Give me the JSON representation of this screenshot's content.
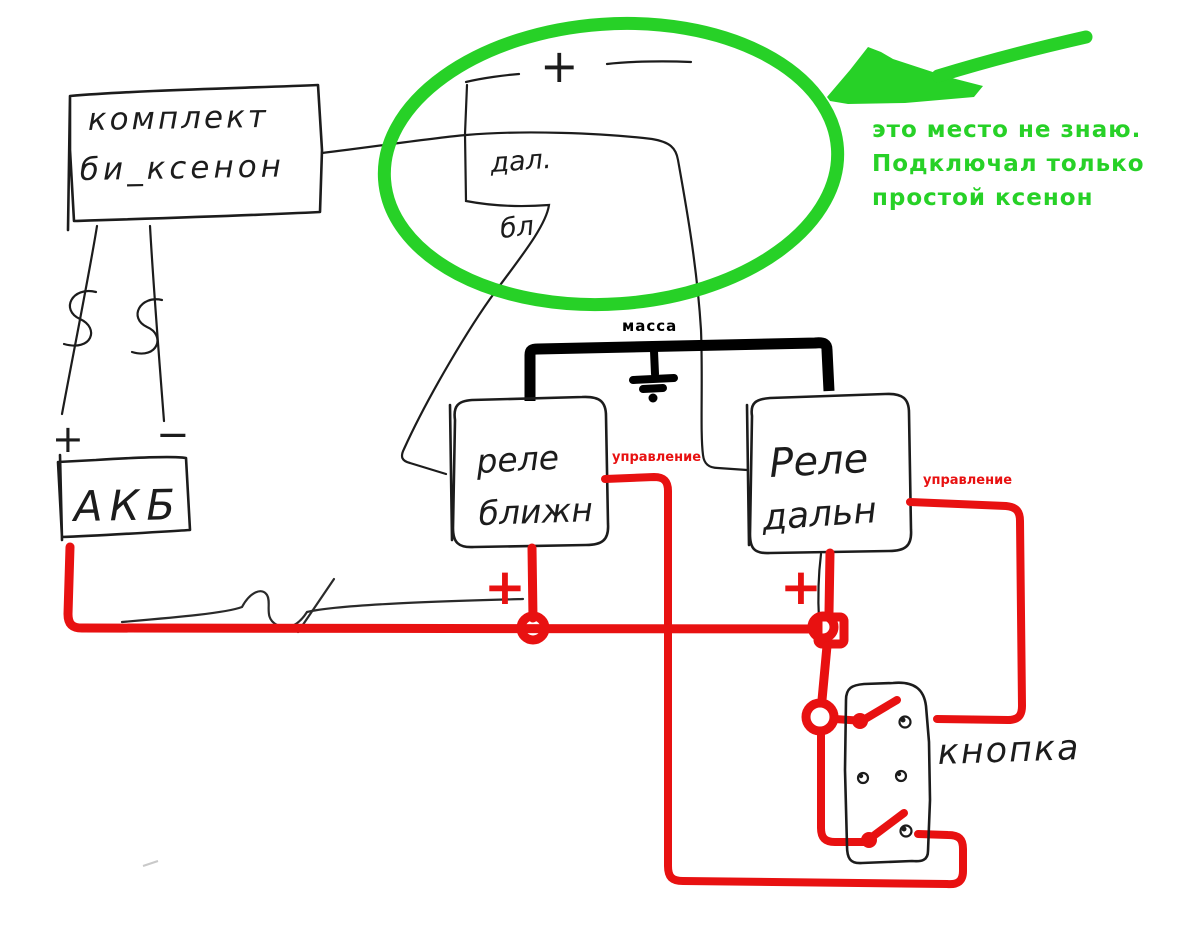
{
  "colors": {
    "ink": "#1c1c1c",
    "massa": "#000000",
    "red": "#e81111",
    "green": "#27d127"
  },
  "kit": {
    "line1": "комплект",
    "line2": "би_ксенон"
  },
  "battery": {
    "label": "АКБ",
    "plus": "+",
    "minus": "−"
  },
  "bulb_terminals": {
    "plus": "+"
  },
  "wires": {
    "high_beam_label": "дал.",
    "low_beam_label": "бл"
  },
  "ground": {
    "label": "масса"
  },
  "relays": {
    "low": {
      "line1": "реле",
      "line2": "ближн"
    },
    "high": {
      "line1": "Реле",
      "line2": "дальн"
    }
  },
  "controls": {
    "left": "управление",
    "right": "управление"
  },
  "power": {
    "plus_left": "+",
    "plus_right": "+"
  },
  "switch": {
    "label": "кнопка"
  },
  "note": {
    "line1": "это место не знаю.",
    "line2": "Подключал только",
    "line3": "простой ксенон"
  }
}
